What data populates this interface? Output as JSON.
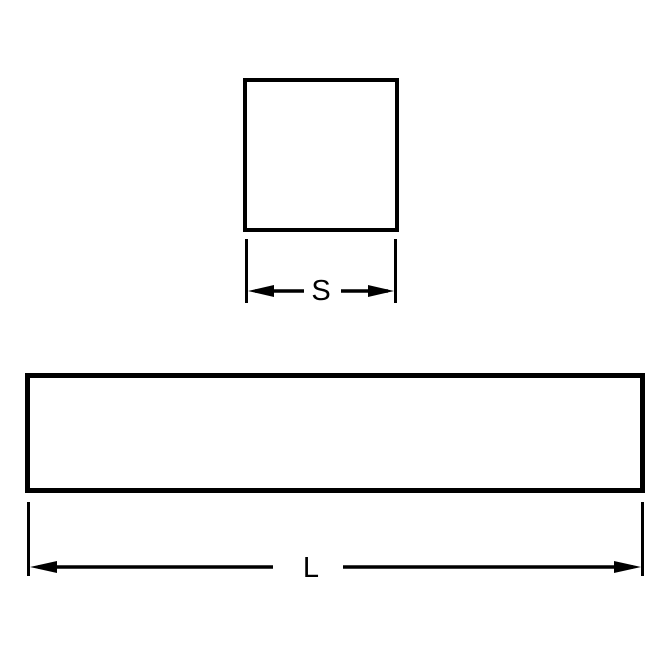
{
  "diagram": {
    "type": "technical-dimension-drawing",
    "description": "Square keystock: square cross-section with side dimension S and long bar side view with length dimension L",
    "line_color": "#000000",
    "background_color": "#ffffff",
    "shapes": [
      {
        "name": "square-cross-section",
        "kind": "square",
        "dimension_label": "S"
      },
      {
        "name": "bar-side-view",
        "kind": "rectangle",
        "dimension_label": "L"
      }
    ],
    "labels": {
      "square_side": "S",
      "bar_length": "L"
    }
  }
}
